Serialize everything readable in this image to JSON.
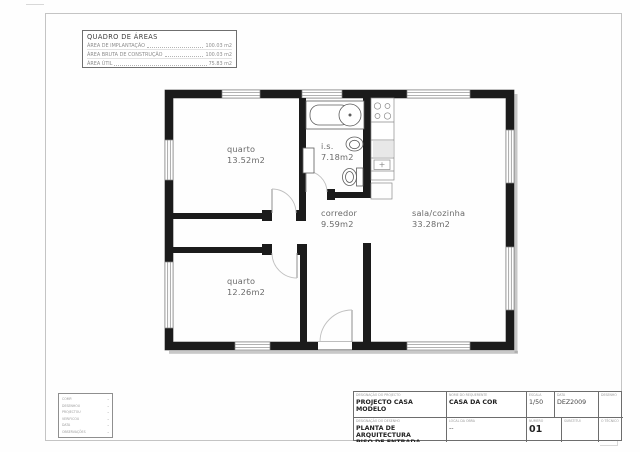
{
  "areas_table": {
    "title": "QUADRO DE ÁREAS",
    "rows": [
      {
        "label": "ÁREA DE IMPLANTAÇÃO",
        "value": "100.03 m2"
      },
      {
        "label": "ÁREA BRUTA DE CONSTRUÇÃO",
        "value": "100.03 m2"
      },
      {
        "label": "ÁREA ÚTIL",
        "value": "75.83 m2"
      }
    ]
  },
  "floor_plan": {
    "rooms": [
      {
        "name": "quarto",
        "area": "13.52m2"
      },
      {
        "name": "i.s.",
        "area": "7.18m2"
      },
      {
        "name": "corredor",
        "area": "9.59m2"
      },
      {
        "name": "sala/cozinha",
        "area": "33.28m2"
      },
      {
        "name": "quarto",
        "area": "12.26m2"
      }
    ]
  },
  "stamp": {
    "rows": [
      {
        "label": "COMP.",
        "value": "–"
      },
      {
        "label": "DESENHOU",
        "value": "–"
      },
      {
        "label": "PROJECTOU",
        "value": "–"
      },
      {
        "label": "VERIFICOU",
        "value": "–"
      },
      {
        "label": "DATA",
        "value": "–"
      },
      {
        "label": "OBSERVAÇÕES",
        "value": "–"
      }
    ]
  },
  "title_block": {
    "project_label": "DESIGNAÇÃO DO PROJECTO",
    "project": "PROJECTO CASA MODELO",
    "client_label": "NOME DO REQUERENTE",
    "client": "CASA DA COR",
    "scale_label": "ESCALA",
    "scale": "1/50",
    "date_label": "DATA",
    "date": "DEZ2009",
    "drawing_label": "DESENHO",
    "drawing": "",
    "drawing_title_label": "DESIGNAÇÃO DO DESENHO",
    "drawing_title_line1": "PLANTA DE ARQUITECTURA",
    "drawing_title_line2": "PISO DE ENTRADA",
    "site_label": "LOCAL DA OBRA",
    "site": "--",
    "number_label": "NÚMERO",
    "number": "01",
    "replaces_label": "SUBSTITUI",
    "technician_label": "O TÉCNICO"
  },
  "colors": {
    "wall_black": "#1b1b1b",
    "hatch_line": "#d2d2d2",
    "shadow": "#9b9b9b",
    "label_gray": "#6a6a6a"
  }
}
